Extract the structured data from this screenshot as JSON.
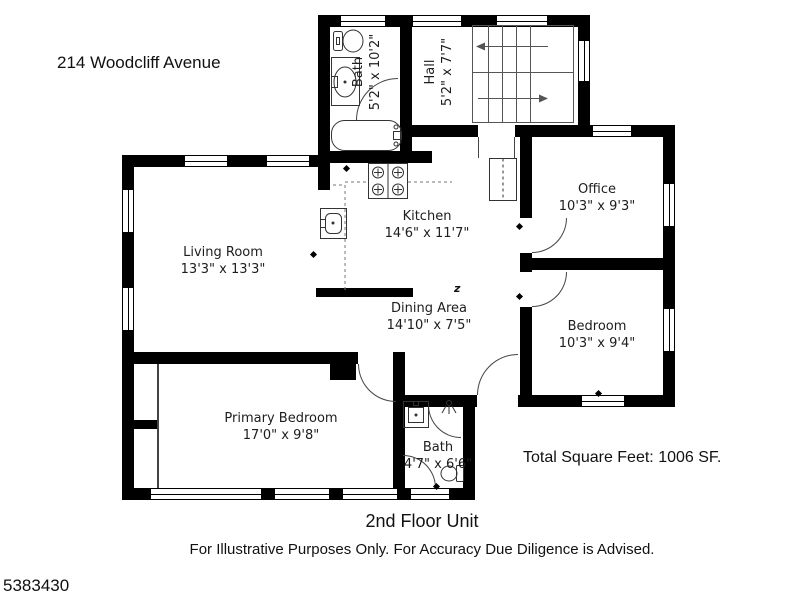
{
  "header": {
    "address": "214 Woodcliff Avenue"
  },
  "plan": {
    "rooms": [
      {
        "name": "Bath",
        "dims": "5'2\" x 10'2\""
      },
      {
        "name": "Hall",
        "dims": "5'2\" x 7'7\""
      },
      {
        "name": "Office",
        "dims": "10'3\" x 9'3\""
      },
      {
        "name": "Kitchen",
        "dims": "14'6\" x 11'7\""
      },
      {
        "name": "Living Room",
        "dims": "13'3\" x 13'3\""
      },
      {
        "name": "Dining Area",
        "dims": "14'10\" x 7'5\""
      },
      {
        "name": "Bedroom",
        "dims": "10'3\" x 9'4\""
      },
      {
        "name": "Primary Bedroom",
        "dims": "17'0\" x 9'8\""
      },
      {
        "name": "Bath",
        "dims": "4'7\" x 6'6\""
      }
    ],
    "total_area": "Total Square Feet:  1006 SF.",
    "fan_symbol": "z"
  },
  "footer": {
    "floor_label": "2nd Floor Unit",
    "disclaimer": "For Illustrative Purposes Only.  For Accuracy Due Diligence is Advised.",
    "listing_id": "5383430"
  },
  "colors": {
    "wall": "#000000",
    "background": "#ffffff",
    "text": "#1d1d1d"
  }
}
